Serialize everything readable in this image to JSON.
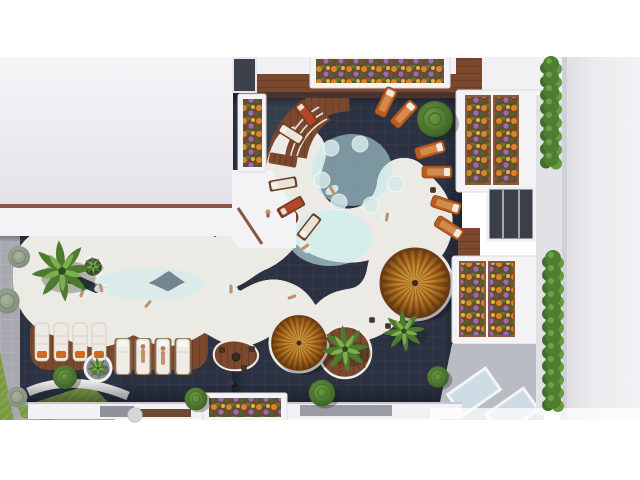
{
  "scene": {
    "type": "aerial-architectural-render",
    "description": "Top-down 3D rendering of a resort courtyard: a curvy turquoise lagoon pool with a round pool section, dark tiled deck, wooden sun decks, two thatched parasols, palm trees, sun loungers, flower planters and white apartment buildings on the left, top and right edges.",
    "no_visible_text": true
  },
  "colors": {
    "white": "#ffffff",
    "pool_light": "#cdf0f1",
    "pool_mid": "#9adbe2",
    "pool_deep": "#4f9cb0",
    "rim_white": "#f7fafa",
    "deck_wood": "#7c492e",
    "deck_wood_dark": "#5e3520",
    "tile_dark": "#2c3242",
    "tile_line": "#3c4356",
    "pavement": "#a8a8b0",
    "grass": "#7c9a44",
    "umbrella_light": "#e2aa4c",
    "umbrella_dark": "#6e3f10",
    "palm_green": "#4c7a2e",
    "palm_light": "#7fae4e",
    "hedge_green": "#4f7d32",
    "bush_sage": "#8e9c86",
    "flower_orange": "#e08326",
    "flower_purple": "#9b6bb5",
    "flower_yellow": "#d8b93a",
    "planter_soil": "#6b4a33",
    "lounger_white": "#edeae3",
    "lounger_orange": "#b85c22",
    "cushion_red": "#b2452a",
    "skin": "#c98e6a",
    "building_white": "#f6f5f8",
    "building_shade": "#e4e2e8",
    "wall_right": "#ebebee",
    "glass": "#ccdbe4"
  },
  "inventory": {
    "pools": 1,
    "round_pool_section": 1,
    "thatched_umbrellas": 2,
    "palm_trees": 5,
    "sun_loungers": 20,
    "flower_planters": 6,
    "in_pool_stools": 6,
    "swimmers": 8,
    "hedge_columns": 2
  },
  "instances": [
    {
      "sym": "stool-pool",
      "x": 331,
      "y": 148
    },
    {
      "sym": "stool-pool",
      "x": 360,
      "y": 144
    },
    {
      "sym": "stool-pool",
      "x": 322,
      "y": 180
    },
    {
      "sym": "stool-pool",
      "x": 339,
      "y": 202
    },
    {
      "sym": "stool-pool",
      "x": 371,
      "y": 205
    },
    {
      "sym": "stool-pool",
      "x": 396,
      "y": 184
    },
    {
      "sym": "swimmer",
      "x": 82,
      "y": 293,
      "r": 20
    },
    {
      "sym": "swimmer",
      "x": 101,
      "y": 288,
      "r": -15
    },
    {
      "sym": "swimmer",
      "x": 148,
      "y": 304,
      "r": 40
    },
    {
      "sym": "swimmer",
      "x": 231,
      "y": 289,
      "r": 0
    },
    {
      "sym": "swimmer",
      "x": 292,
      "y": 297,
      "r": 70
    },
    {
      "sym": "swimmer",
      "x": 332,
      "y": 190,
      "r": -30
    },
    {
      "sym": "swimmer",
      "x": 387,
      "y": 217,
      "r": 10
    },
    {
      "sym": "swimmer",
      "x": 305,
      "y": 247,
      "r": 55
    },
    {
      "sym": "umbrella",
      "x": 415,
      "y": 283,
      "s": 1.06
    },
    {
      "sym": "umbrella",
      "x": 299,
      "y": 343,
      "s": 0.85
    },
    {
      "sym": "table-round",
      "x": 236,
      "y": 357
    },
    {
      "sym": "stool-dark",
      "x": 222,
      "y": 350
    },
    {
      "sym": "stool-dark",
      "x": 252,
      "y": 349
    },
    {
      "sym": "stool-dark",
      "x": 244,
      "y": 368
    },
    {
      "sym": "stool-dark",
      "x": 372,
      "y": 320
    },
    {
      "sym": "stool-dark",
      "x": 388,
      "y": 326
    },
    {
      "sym": "stool-dark",
      "x": 397,
      "y": 120
    },
    {
      "sym": "stool-dark",
      "x": 433,
      "y": 190
    },
    {
      "sym": "chair",
      "x": 331,
      "y": 340,
      "r": -30
    },
    {
      "sym": "chair",
      "x": 361,
      "y": 365,
      "r": 150
    },
    {
      "sym": "lounger-white",
      "x": 42,
      "y": 342,
      "n": 4,
      "dx": 19
    },
    {
      "sym": "lounger-tan",
      "x": 123,
      "y": 356,
      "n": 4,
      "dx": 20
    },
    {
      "sym": "person-lying",
      "x": 143,
      "y": 356
    },
    {
      "sym": "person-lying",
      "x": 163,
      "y": 358
    },
    {
      "sym": "rlounger-white",
      "x": 309,
      "y": 227,
      "r": 218
    },
    {
      "sym": "rlounger-red",
      "x": 291,
      "y": 207,
      "r": 240
    },
    {
      "sym": "rlounger-white",
      "x": 283,
      "y": 184,
      "r": 260
    },
    {
      "sym": "rlounger-wood",
      "x": 283,
      "y": 160,
      "r": 280
    },
    {
      "sym": "rlounger-white",
      "x": 291,
      "y": 134,
      "r": 302
    },
    {
      "sym": "rlounger-red",
      "x": 306,
      "y": 114,
      "r": 322
    },
    {
      "sym": "lounger-orange",
      "x": 386,
      "y": 102,
      "r": 26
    },
    {
      "sym": "lounger-orange",
      "x": 404,
      "y": 114,
      "r": 42
    },
    {
      "sym": "lounger-orange",
      "x": 430,
      "y": 150,
      "r": 74
    },
    {
      "sym": "lounger-orange",
      "x": 437,
      "y": 172,
      "r": 90
    },
    {
      "sym": "lounger-orange",
      "x": 446,
      "y": 205,
      "r": 108
    },
    {
      "sym": "lounger-orange",
      "x": 449,
      "y": 228,
      "r": 122
    },
    {
      "sym": "person",
      "x": 231,
      "y": 383
    },
    {
      "sym": "sitter",
      "x": 268,
      "y": 212
    },
    {
      "sym": "palm",
      "x": 62,
      "y": 271,
      "s": 1.6
    },
    {
      "sym": "palm",
      "x": 93,
      "y": 266,
      "s": 0.5
    },
    {
      "sym": "palm",
      "x": 98,
      "y": 368,
      "s": 0.55
    },
    {
      "sym": "palm",
      "x": 345,
      "y": 349,
      "s": 1.25
    },
    {
      "sym": "palm",
      "x": 404,
      "y": 331,
      "s": 1.1
    },
    {
      "sym": "bush",
      "x": 435,
      "y": 119,
      "s": 1.5
    },
    {
      "sym": "bush",
      "x": 322,
      "y": 393,
      "s": 1.1
    },
    {
      "sym": "bush",
      "x": 438,
      "y": 377,
      "s": 0.9
    },
    {
      "sym": "bush",
      "x": 196,
      "y": 399,
      "s": 0.95
    },
    {
      "sym": "bush",
      "x": 65,
      "y": 377,
      "s": 1.0
    },
    {
      "sym": "bush-sage",
      "x": 19,
      "y": 257
    },
    {
      "sym": "bush-sage",
      "x": 7,
      "y": 301,
      "s": 1.15
    },
    {
      "sym": "bush-sage",
      "x": 17,
      "y": 397,
      "s": 0.95
    },
    {
      "sym": "stone",
      "x": 135,
      "y": 415,
      "s": 0.8
    },
    {
      "sym": "hedge",
      "x": 551,
      "y": 64,
      "n": 8,
      "dy": 13.5
    },
    {
      "sym": "hedge",
      "x": 553,
      "y": 258,
      "n": 12,
      "dy": 13
    }
  ]
}
